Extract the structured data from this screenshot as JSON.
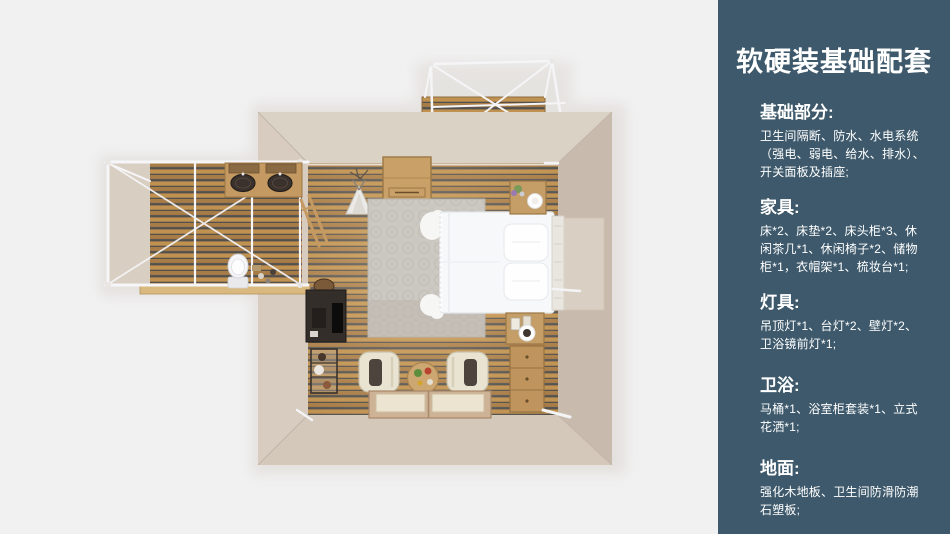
{
  "canvas": {
    "width": 950,
    "height": 534,
    "background": "#f1f1f2"
  },
  "sidebar": {
    "background": "#3d596b",
    "text_color": "#ffffff",
    "title": "软硬装基础配套",
    "sections": [
      {
        "heading": "基础部分:",
        "lines": [
          "卫生间隔断、防水、水电系统",
          "（强电、弱电、给水、排水）、",
          "开关面板及插座;"
        ]
      },
      {
        "heading": "家具:",
        "lines": [
          "床*2、床垫*2、床头柜*3、休",
          "闲茶几*1、休闲椅子*2、储物",
          "柜*1，衣帽架*1、梳妆台*1;"
        ]
      },
      {
        "heading": "灯具:",
        "lines": [
          "吊顶灯*1、台灯*2、壁灯*2、",
          "卫浴镜前灯*1;"
        ]
      },
      {
        "heading": "卫浴:",
        "lines": [
          "马桶*1、浴室柜套装*1、立式",
          "花洒*1;"
        ]
      },
      {
        "heading": "地面:",
        "lines": [
          "强化木地板、卫生间防滑防潮",
          "石塑板;"
        ]
      }
    ]
  },
  "floorplan": {
    "description": "顶视3D卧室户型渲染图：主卧带阳台与卫生间",
    "items": [
      "双人床",
      "床头柜",
      "储物柜",
      "休闲椅×2",
      "休闲茶几",
      "榻榻米床×2",
      "书桌",
      "衣帽架",
      "马桶",
      "双盆浴室柜",
      "阳台木平台"
    ],
    "palette": {
      "background": "#f1f1f2",
      "wall": "#d3c8bb",
      "plank_light": "#c0914f",
      "plank_dark": "#a87c46",
      "plank_gap": "#53504e",
      "rug": "#ccc8c2",
      "bed": "#f7f8fa",
      "wood_furniture": "#c59d66",
      "frame_white": "#f5f5f7"
    }
  }
}
